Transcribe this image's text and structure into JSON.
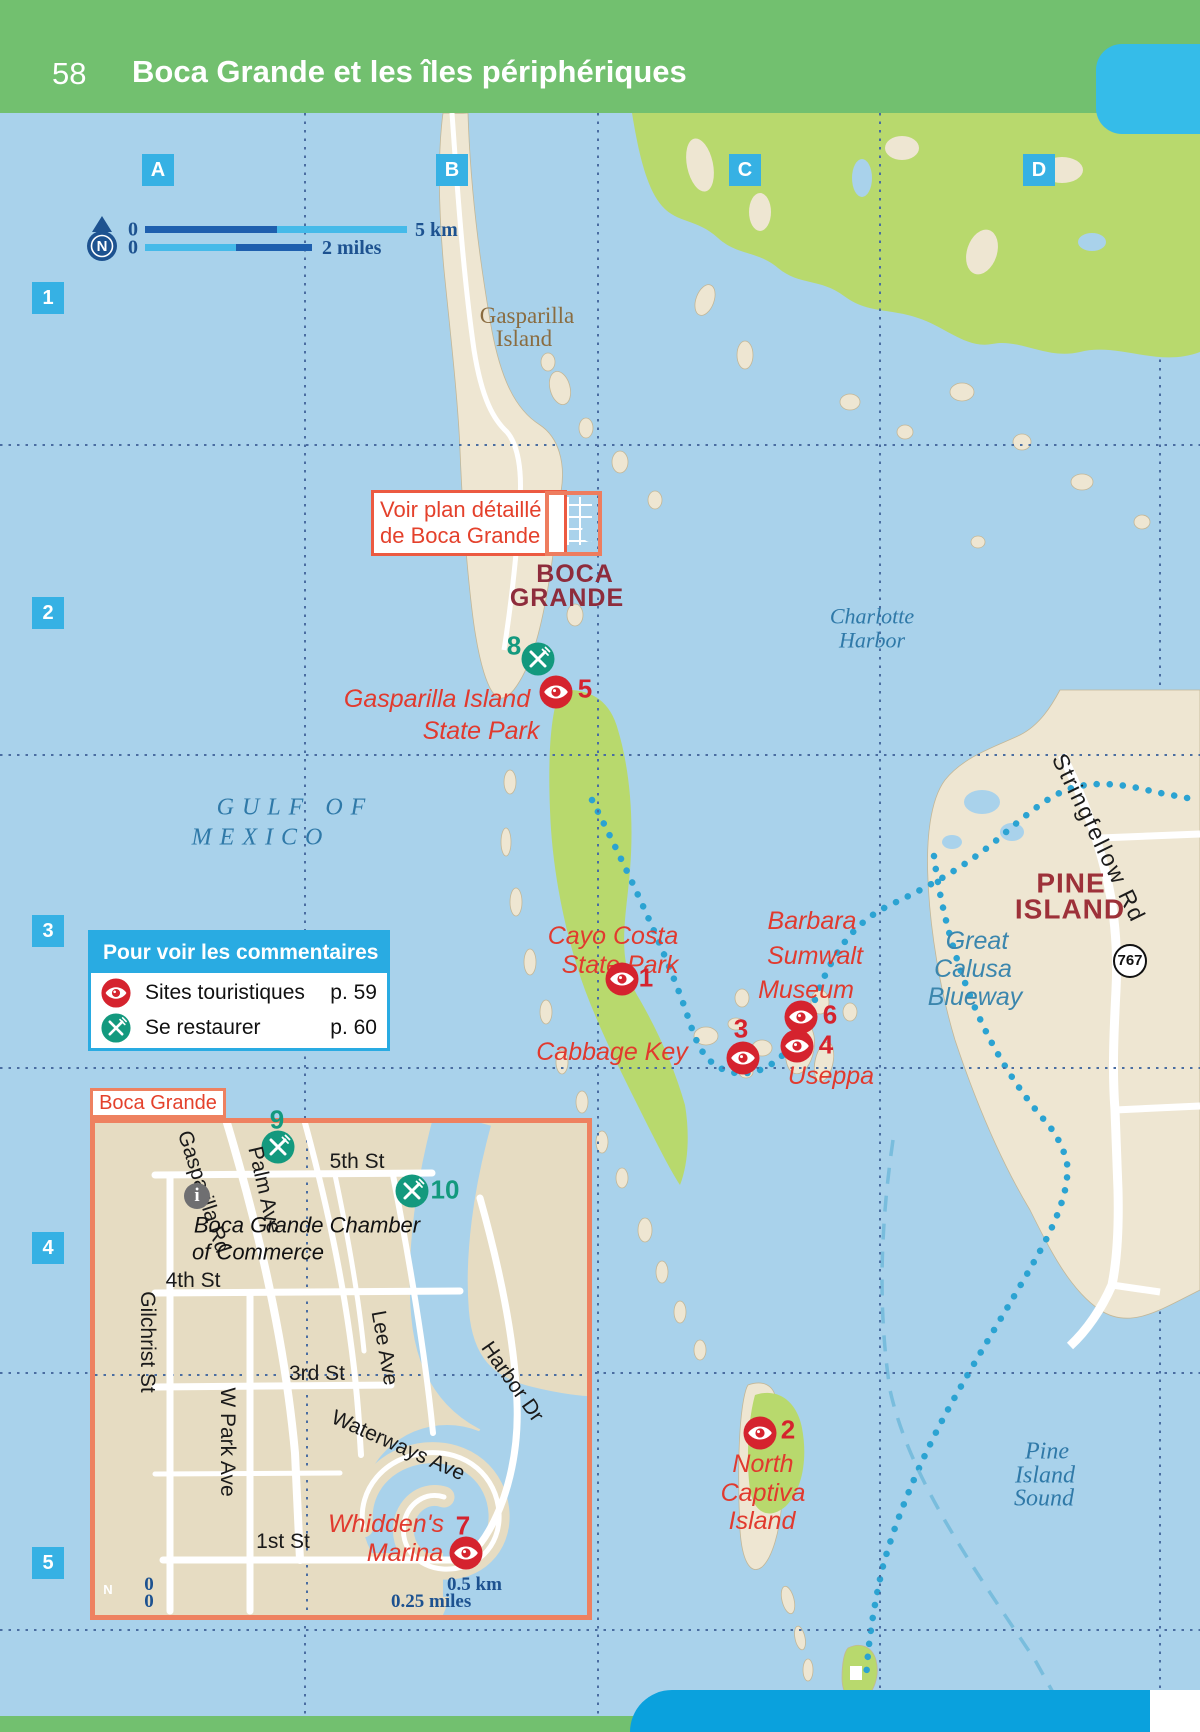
{
  "header": {
    "page_number": "58",
    "title": "Boca Grande et les îles périphériques"
  },
  "grid": {
    "cols": [
      "A",
      "B",
      "C",
      "D"
    ],
    "rows": [
      "1",
      "2",
      "3",
      "4",
      "5"
    ]
  },
  "compass": {
    "letter": "N"
  },
  "scale_top": {
    "zero1": "0",
    "label1": "5 km",
    "zero2": "0",
    "label2": "2 miles"
  },
  "scale_inset": {
    "zero1": "0",
    "label1": "0.5 km",
    "zero2": "0",
    "label2": "0.25 miles"
  },
  "legend": {
    "title": "Pour voir les commentaires",
    "sites_label": "Sites touristiques",
    "sites_page": "p. 59",
    "food_label": "Se restaurer",
    "food_page": "p. 60"
  },
  "callout": {
    "line1": "Voir plan détaillé",
    "line2": "de Boca Grande"
  },
  "water_labels": {
    "charlotte1": "Charlotte",
    "charlotte2": "Harbor",
    "gulf1": "GULF OF",
    "gulf2": "MEXICO",
    "pis1": "Pine",
    "pis2": "Island",
    "pis3": "Sound",
    "blueway1": "Great",
    "blueway2": "Calusa",
    "blueway3": "Blueway"
  },
  "places": {
    "gasp1": "Gasparilla",
    "gasp2": "Island",
    "boca1": "BOCA",
    "boca2": "GRANDE",
    "pine1": "PINE",
    "pine2": "ISLAND",
    "stringfellow": "Stringfellow Rd",
    "route": "767"
  },
  "sites": {
    "cayo1": "Cayo Costa",
    "cayo2": "State Park",
    "museum1": "Barbara",
    "museum2": "Sumwalt",
    "museum3": "Museum",
    "cabbage": "Cabbage Key",
    "useppa": "Useppa",
    "gisp1": "Gasparilla Island",
    "gisp2": "State Park",
    "nc1": "North",
    "nc2": "Captiva",
    "nc3": "Island",
    "whidden1": "Whidden's",
    "whidden2": "Marina"
  },
  "markers": {
    "m1": "1",
    "m2": "2",
    "m3": "3",
    "m4": "4",
    "m5": "5",
    "m6": "6",
    "m7": "7",
    "m8": "8",
    "m9": "9",
    "m10": "10"
  },
  "inset": {
    "tab": "Boca Grande",
    "streets": {
      "s5": "5th St",
      "s4": "4th St",
      "s3": "3rd St",
      "s1": "1st St",
      "gasparilla": "Gasparilla Rd",
      "palm": "Palm Ave",
      "gilchrist": "Gilchrist St",
      "wpark": "W Park Ave",
      "lee": "Lee Ave",
      "waterways": "Waterways Ave",
      "harbor": "Harbor Dr"
    },
    "chamber1": "Boca Grande Chamber",
    "chamber2": "of Commerce",
    "info": "i"
  },
  "colors": {
    "header_green": "#72c06f",
    "accent_cyan": "#29abe2",
    "water": "#a9d2eb",
    "marker_red": "#d5232e",
    "restaurant_teal": "#13997e",
    "site_text_red": "#e13a2e",
    "inset_border_orange": "#ee8160",
    "navy": "#1d5290"
  }
}
